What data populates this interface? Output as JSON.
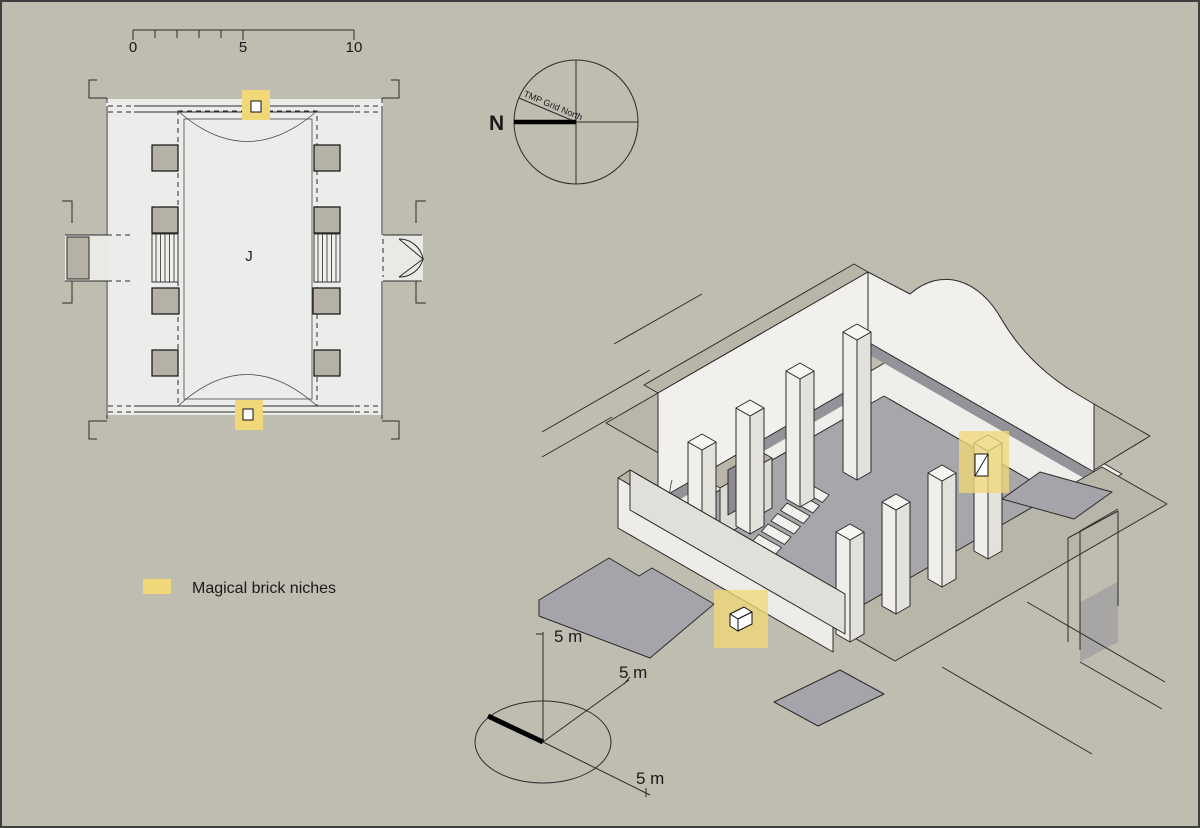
{
  "scale_bar": {
    "tick_0": "0",
    "tick_5": "5",
    "tick_10": "10"
  },
  "compass": {
    "north_label": "N",
    "grid_north_label": "TMP Grid North"
  },
  "floor_plan": {
    "chamber_label": "J"
  },
  "legend": {
    "niche_label": "Magical brick niches"
  },
  "iso_axes": {
    "up_label": "5 m",
    "ne_label": "5 m",
    "se_label": "5 m"
  },
  "colors": {
    "background": "#bfbcb0",
    "accent_yellow": "#f0d878",
    "floor_gray": "#a7a6ab",
    "wall_white": "#f1f0ec",
    "line": "#2b2b2b"
  }
}
